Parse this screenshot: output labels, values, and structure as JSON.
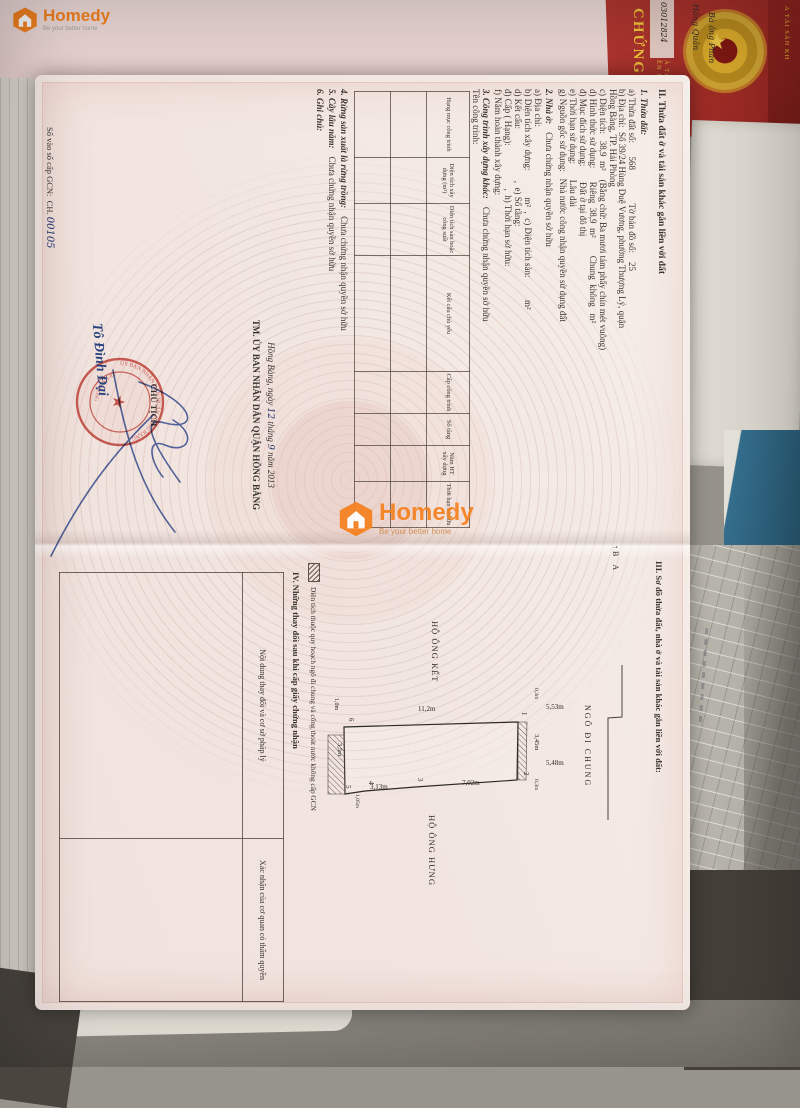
{
  "overlay": {
    "brand": "Homedy",
    "tagline": "Be your better home"
  },
  "background": {
    "cover_big": "CHỨNG",
    "cover_line1": "ỀN SỬ DỤNG",
    "cover_line2": "À TÀI SẢN",
    "cover_edge": "A TÀI SẢN KH",
    "handwriting_1": "03012824",
    "handwriting_2": "Hồng Quân",
    "handwriting_3": "Bà ông Phan"
  },
  "page_left": {
    "heading": "II. Thửa đất ở và tài sản khác gắn liền với đất",
    "s1_title": "1. Thửa đất:",
    "lines": {
      "a": "a) Thửa đất số:      568               Tờ bản đồ số:    25",
      "b1": "b) Địa chỉ:  Số 39/24 Hùng Duệ Vương, phường Thượng Lý, quận",
      "b2": "Hồng Bàng, TP. Hải Phòng",
      "c": "c) Diện tích:   38,9  m²    (Bằng chữ: Ba mươi tám phẩy chín mét vuông)",
      "d": "d) Hình thức sử dụng:      Riêng  38,9  m²        Chung  không   m²",
      "dd": "đ) Mục đích sử dụng:       Đất ở tại đô thị",
      "e": "e) Thời hạn sử dụng:       Lâu dài",
      "g": "g) Nguồn gốc sử dụng:   Nhà nước công nhận quyền sử dụng đất"
    },
    "s2_label": "2. Nhà ở:",
    "s2_value": "Chưa chứng nhận quyền sở hữu",
    "house_lines": {
      "a": "a) Địa chỉ:",
      "b": "b) Diện tích xây dựng:            m²  ,  c) Diện tích sàn:          m²",
      "d": "d) Kết cấu:                       ,  e) Số tầng:",
      "dd": "đ) Cấp ( Hạng):                   ,  h) Thời hạn sở hữu:",
      "f": "f) Năm hoàn thành xây dựng:"
    },
    "s3_label": "3. Công trình xây dựng khác:",
    "s3_value": "Chưa chứng nhận quyền sở hữu",
    "ten_cong_trinh": "Tên công trình:",
    "table_headers": [
      "Hạng mục công trình",
      "Diện tích xây dựng (m²)",
      "Diện tích sàn hoặc công suất",
      "Kết cấu chủ yếu",
      "Cấp công trình",
      "Số tầng",
      "Năm HT xây dựng",
      "Thời hạn sở hữu"
    ],
    "s4_label": "4. Rừng sản xuất là rừng trồng:",
    "s4_value": "Chưa chứng nhận quyền sở hữu",
    "s5_label": "5. Cây lâu năm:",
    "s5_value": "Chưa chứng nhận quyền sở hữu",
    "s6_label": "6. Ghi chú:",
    "date_prefix": "Hồng Bàng, ngày ",
    "date_day": "12",
    "date_mid": " tháng ",
    "date_month": "9",
    "date_suffix": " năm 2013",
    "committee": "TM. ỦY BAN NHÂN DÂN QUẬN HỒNG BÀNG",
    "chairman_title": "CHỦ TỊCH",
    "chairman_name": "Tô Đình Đại",
    "stamp_top": "ỦY BAN NHÂN DÂN QUẬN HỒNG BÀNG",
    "stamp_bottom": "TP. HẢI PHÒNG",
    "stamp_center": "★",
    "book_prefix": "Số vào sổ cấp GCN:",
    "book_series": "CH.",
    "book_number": "00105"
  },
  "page_right": {
    "heading": "III. Sơ đồ thửa đất, nhà ở và tài sản khác gắn liền với đất:",
    "north_b": "B",
    "north_a": "A",
    "alley": "NGÕ ĐI CHUNG",
    "neighbor_left": "HỘ ÔNG KẾT",
    "neighbor_right": "HỘ ÔNG HƯNG",
    "dims": {
      "left_edge": "11,2m",
      "top_edge": "3,45m",
      "strip_left": "0,3m",
      "strip_right": "0,3m",
      "alley_1": "5,53m",
      "alley_2": "5,48m",
      "right_1": "7,02m",
      "right_2": "3,13m",
      "right_3": "1,05m",
      "bottom_area": "3,5m",
      "bottom_depth": "1,0m"
    },
    "points": {
      "p1": "1",
      "p2": "2",
      "p3": "3",
      "p4": "4",
      "p5": "5",
      "p6": "6"
    },
    "legend": "Diện tích thuộc quy hoạch ngõ đi chung và cống thoát nước không cấp GCN",
    "s4_heading": "IV. Những thay đổi sau khi cấp giấy chứng nhận",
    "change_table": {
      "col1": "Nội dung thay đổi và cơ sở pháp lý",
      "col2": "Xác nhận của cơ quan có thẩm quyền"
    }
  }
}
